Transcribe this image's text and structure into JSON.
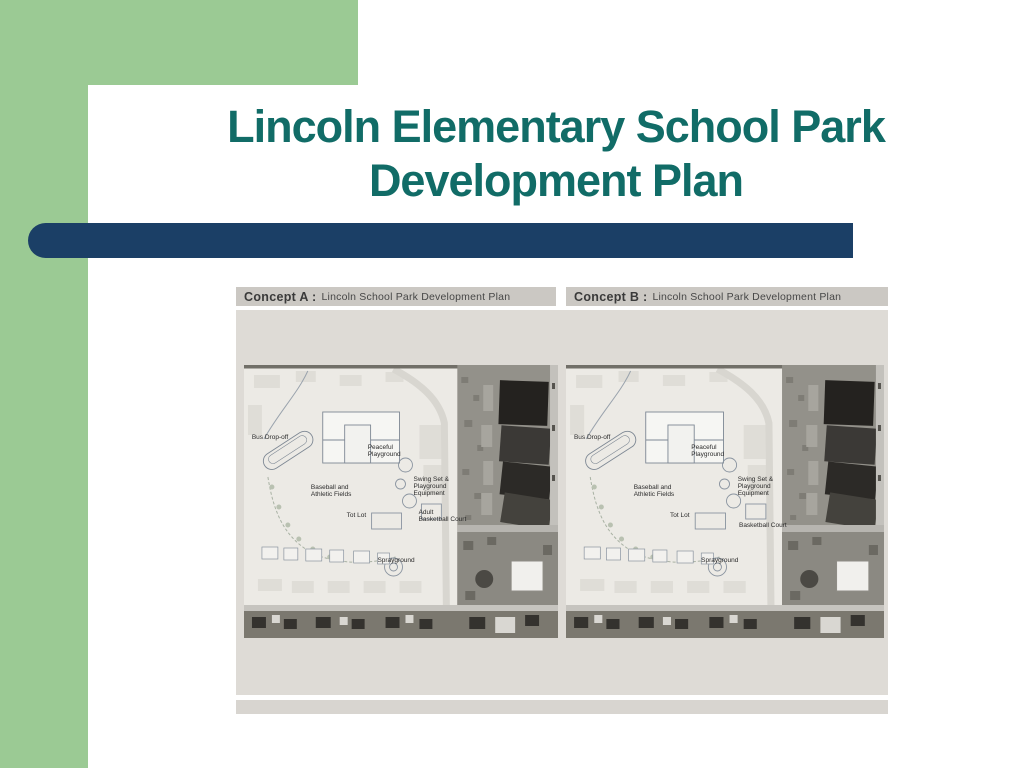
{
  "slide": {
    "title_line1": "Lincoln Elementary School Park",
    "title_line2": "Development Plan"
  },
  "colors": {
    "frame_green": "#9BCA94",
    "title_teal": "#116C67",
    "divider_navy": "#1B3F66",
    "header_bar_gray": "#CBC8C3",
    "panel_gray": "#DEDBD6"
  },
  "figure": {
    "concepts": [
      {
        "header_label": "Concept A :",
        "header_title": "Lincoln School Park Development Plan",
        "labels": {
          "bus": "Bus Drop-off",
          "peaceful": "Peaceful\nPlayground",
          "baseball": "Baseball and\nAthletic Fields",
          "swing": "Swing Set &\nPlayground\nEquipment",
          "totlot": "Tot Lot",
          "basketball": "Adult\nBasketball Court",
          "sprayground": "Sprayground"
        }
      },
      {
        "header_label": "Concept B :",
        "header_title": "Lincoln School Park Development Plan",
        "labels": {
          "bus": "Bus Drop-off",
          "peaceful": "Peaceful\nPlayground",
          "baseball": "Baseball and\nAthletic Fields",
          "swing": "Swing Set &\nPlayground\nEquipment",
          "totlot": "Tot Lot",
          "basketball": "Basketball Court",
          "sprayground": "Sprayground"
        }
      }
    ]
  }
}
